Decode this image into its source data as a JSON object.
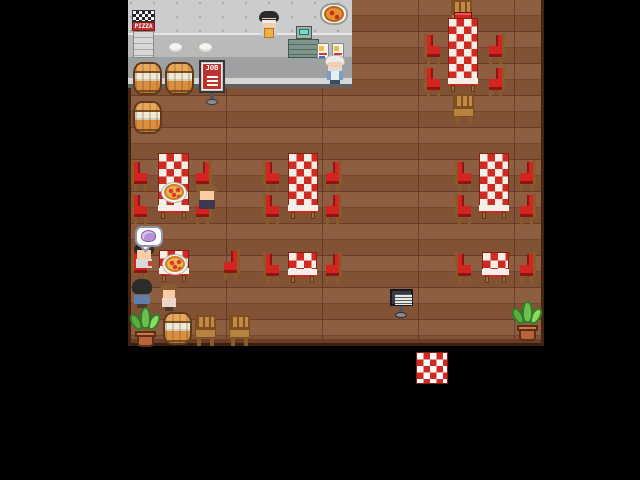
{
  "scene": {
    "description": "Top-down pixel-art pizzeria restaurant interior on black letterboxed background",
    "viewport": {
      "x": 128,
      "y": 0,
      "width": 416,
      "height": 384
    }
  },
  "text": {
    "oven_sign": "PIZZA",
    "job_sign": "JOB"
  },
  "palette": {
    "floor": "#8a5738",
    "floor_line": "#6e402a",
    "cloth_red": "#cf2b22",
    "cloth_white": "#f4f0e8",
    "chair_red": "#d42420",
    "sign_red": "#c03030",
    "register": "#7e958b",
    "slime": "#b98fd9",
    "wall_gray": "#cbcccd",
    "counter_gray": "#a7a8a9"
  },
  "sprites": [
    {
      "type": "oven",
      "name": "pizza-oven-cabinet",
      "x": 4,
      "y": 10,
      "interactable": false
    },
    {
      "type": "plate",
      "name": "counter-plate",
      "x": 40,
      "y": 42,
      "interactable": false
    },
    {
      "type": "plate",
      "name": "counter-plate",
      "x": 70,
      "y": 42,
      "interactable": false
    },
    {
      "type": "char-clerk",
      "name": "npc-clerk",
      "x": 130,
      "y": 11,
      "interactable": true
    },
    {
      "type": "register",
      "name": "cash-register",
      "x": 160,
      "y": 26,
      "interactable": true
    },
    {
      "type": "wallpizza",
      "name": "pizza-wall-sign",
      "x": 192,
      "y": 3,
      "interactable": false
    },
    {
      "type": "poster",
      "name": "menu-poster",
      "x": 189,
      "y": 43,
      "interactable": false
    },
    {
      "type": "poster",
      "name": "menu-poster",
      "x": 204,
      "y": 43,
      "interactable": false
    },
    {
      "type": "jobsign",
      "name": "job-board-sign",
      "x": 70,
      "y": 60,
      "interactable": true
    },
    {
      "type": "barrel",
      "name": "barrel",
      "x": 5,
      "y": 62,
      "interactable": false
    },
    {
      "type": "barrel",
      "name": "barrel",
      "x": 37,
      "y": 62,
      "interactable": false
    },
    {
      "type": "barrel",
      "name": "barrel",
      "x": 5,
      "y": 101,
      "interactable": false
    },
    {
      "type": "char-oldman",
      "name": "npc-old-man",
      "x": 196,
      "y": 55,
      "interactable": true
    },
    {
      "type": "chair-wood",
      "name": "wooden-chair",
      "x": 322,
      "y": 0,
      "interactable": false
    },
    {
      "type": "chair-red-back",
      "name": "red-chair",
      "x": 326,
      "y": 12,
      "interactable": false
    },
    {
      "type": "table",
      "name": "dining-table",
      "x": 320,
      "y": 18,
      "w": 30,
      "h": 74,
      "interactable": false
    },
    {
      "type": "chair-red",
      "name": "red-chair",
      "x": 296,
      "y": 33,
      "interactable": false
    },
    {
      "type": "chair-red",
      "name": "red-chair",
      "x": 296,
      "y": 66,
      "interactable": false
    },
    {
      "type": "chair-red",
      "name": "red-chair",
      "x": 360,
      "y": 33,
      "dir": "R",
      "interactable": false
    },
    {
      "type": "chair-red",
      "name": "red-chair",
      "x": 360,
      "y": 66,
      "dir": "R",
      "interactable": false
    },
    {
      "type": "chair-wood",
      "name": "wooden-chair",
      "x": 324,
      "y": 94,
      "interactable": false
    },
    {
      "type": "table",
      "name": "dining-table",
      "x": 30,
      "y": 153,
      "w": 31,
      "h": 66,
      "interactable": false
    },
    {
      "type": "chair-red",
      "name": "red-chair",
      "x": 3,
      "y": 160,
      "interactable": false
    },
    {
      "type": "chair-red",
      "name": "red-chair",
      "x": 3,
      "y": 193,
      "interactable": false
    },
    {
      "type": "chair-red",
      "name": "red-chair",
      "x": 67,
      "y": 160,
      "dir": "R",
      "interactable": false
    },
    {
      "type": "chair-red",
      "name": "red-chair",
      "x": 67,
      "y": 193,
      "dir": "R",
      "interactable": false
    },
    {
      "type": "pizza",
      "name": "pizza-dish",
      "x": 33,
      "y": 182,
      "interactable": false
    },
    {
      "type": "char-girl",
      "name": "npc-diner-brown-hair",
      "x": 68,
      "y": 184,
      "interactable": true
    },
    {
      "type": "table",
      "name": "dining-table",
      "x": 160,
      "y": 153,
      "w": 30,
      "h": 66,
      "interactable": false
    },
    {
      "type": "chair-red",
      "name": "red-chair",
      "x": 135,
      "y": 160,
      "interactable": false
    },
    {
      "type": "chair-red",
      "name": "red-chair",
      "x": 135,
      "y": 193,
      "interactable": false
    },
    {
      "type": "chair-red",
      "name": "red-chair",
      "x": 197,
      "y": 160,
      "dir": "R",
      "interactable": false
    },
    {
      "type": "chair-red",
      "name": "red-chair",
      "x": 197,
      "y": 193,
      "dir": "R",
      "interactable": false
    },
    {
      "type": "table",
      "name": "dining-table",
      "x": 351,
      "y": 153,
      "w": 30,
      "h": 66,
      "interactable": false
    },
    {
      "type": "chair-red",
      "name": "red-chair",
      "x": 327,
      "y": 160,
      "interactable": false
    },
    {
      "type": "chair-red",
      "name": "red-chair",
      "x": 327,
      "y": 193,
      "interactable": false
    },
    {
      "type": "chair-red",
      "name": "red-chair",
      "x": 391,
      "y": 160,
      "dir": "R",
      "interactable": false
    },
    {
      "type": "chair-red",
      "name": "red-chair",
      "x": 391,
      "y": 193,
      "dir": "R",
      "interactable": false
    },
    {
      "type": "chair-red",
      "name": "red-chair",
      "x": 3,
      "y": 249,
      "interactable": false
    },
    {
      "type": "table",
      "name": "dining-table-small",
      "x": 31,
      "y": 250,
      "w": 30,
      "h": 32,
      "interactable": false
    },
    {
      "type": "pizza",
      "name": "pizza-dish",
      "x": 34,
      "y": 254,
      "interactable": false
    },
    {
      "type": "chair-red",
      "name": "red-chair",
      "x": 95,
      "y": 249,
      "dir": "R",
      "interactable": false
    },
    {
      "type": "char-blacksit",
      "name": "npc-diner-black-hair",
      "x": 5,
      "y": 243,
      "interactable": true
    },
    {
      "type": "bubble",
      "name": "speech-bubble-slime",
      "x": 7,
      "y": 226,
      "interactable": false
    },
    {
      "type": "table",
      "name": "dining-table-small",
      "x": 160,
      "y": 252,
      "w": 29,
      "h": 31,
      "interactable": false
    },
    {
      "type": "chair-red",
      "name": "red-chair",
      "x": 135,
      "y": 252,
      "interactable": false
    },
    {
      "type": "chair-red",
      "name": "red-chair",
      "x": 197,
      "y": 252,
      "dir": "R",
      "interactable": false
    },
    {
      "type": "table",
      "name": "dining-table-small",
      "x": 354,
      "y": 252,
      "w": 27,
      "h": 31,
      "interactable": false
    },
    {
      "type": "chair-red",
      "name": "red-chair",
      "x": 327,
      "y": 252,
      "interactable": false
    },
    {
      "type": "chair-red",
      "name": "red-chair",
      "x": 391,
      "y": 252,
      "dir": "R",
      "interactable": false
    },
    {
      "type": "char-blackstand",
      "name": "npc-standing-black-hair",
      "x": 3,
      "y": 279,
      "interactable": true
    },
    {
      "type": "char-kid",
      "name": "npc-child-brown-hair",
      "x": 31,
      "y": 284,
      "interactable": true
    },
    {
      "type": "plant",
      "name": "potted-plant",
      "x": 1,
      "y": 305,
      "interactable": false
    },
    {
      "type": "barrel",
      "name": "barrel",
      "x": 35,
      "y": 312,
      "interactable": false
    },
    {
      "type": "chair-wood",
      "name": "wooden-chair",
      "x": 66,
      "y": 315,
      "interactable": false
    },
    {
      "type": "chair-wood",
      "name": "wooden-chair",
      "x": 100,
      "y": 315,
      "interactable": false
    },
    {
      "type": "infosign",
      "name": "menu-stand-sign",
      "x": 262,
      "y": 289,
      "interactable": true
    },
    {
      "type": "plant",
      "name": "potted-plant",
      "x": 383,
      "y": 299,
      "interactable": false
    },
    {
      "type": "mat",
      "name": "entrance-mat",
      "x": 288,
      "y": 352,
      "interactable": true
    }
  ]
}
